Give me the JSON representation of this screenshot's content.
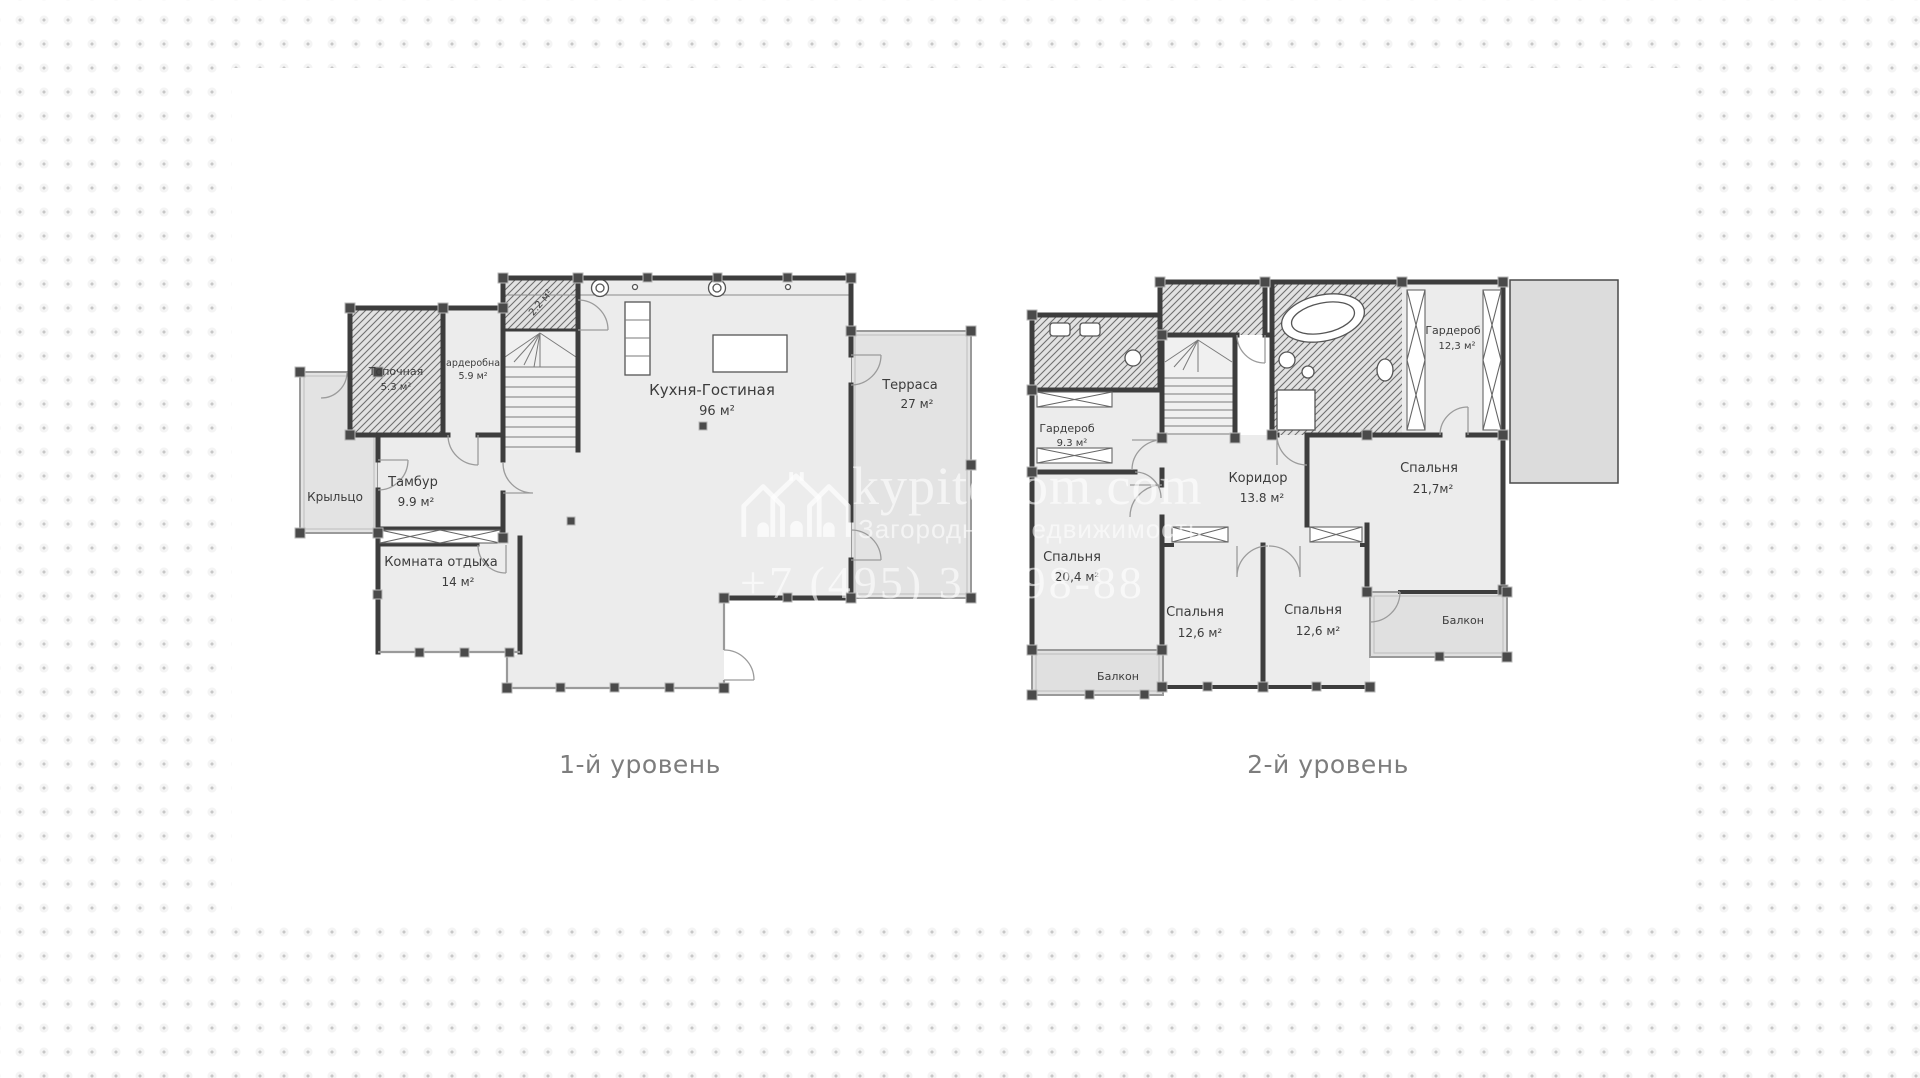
{
  "colors": {
    "wall": "#3d3d3d",
    "room_fill": "#ececec",
    "terrace_fill": "#e3e3e3",
    "background_dot": "#c7c7c7",
    "caption_text": "#7d7d7d",
    "watermark_white": "#ffffff"
  },
  "watermark": {
    "site": "kypitedom.com",
    "tagline": "Загородная недвижимость",
    "phone": "+7 (495) 3    98-88",
    "logo_icon": "houses-logo"
  },
  "plans": {
    "level1": {
      "caption": "1-й уровень",
      "rooms": {
        "boiler": {
          "name": "Топочная",
          "area": "5.3 м²"
        },
        "wardrobe": {
          "name": "Гардеробная",
          "area": "5.9 м²"
        },
        "closet": {
          "area": "2.2 м²"
        },
        "kitchen": {
          "name": "Кухня-Гостиная",
          "area": "96 м²"
        },
        "terrace": {
          "name": "Терраса",
          "area": "27 м²"
        },
        "porch": {
          "name": "Крыльцо"
        },
        "hall": {
          "name": "Тамбур",
          "area": "9.9 м²"
        },
        "lounge": {
          "name": "Комната отдыха",
          "area": "14 м²"
        }
      }
    },
    "level2": {
      "caption": "2-й уровень",
      "rooms": {
        "wardrobe1": {
          "name": "Гардероб",
          "area": "9.3 м²"
        },
        "bedroom1": {
          "name": "Спальня",
          "area": "20,4 м²"
        },
        "balcony1": {
          "name": "Балкон"
        },
        "corridor": {
          "name": "Коридор",
          "area": "13.8 м²"
        },
        "bedroom2": {
          "name": "Спальня",
          "area": "12,6 м²"
        },
        "bedroom3": {
          "name": "Спальня",
          "area": "12,6 м²"
        },
        "bedroom4": {
          "name": "Спальня",
          "area": "21,7м²"
        },
        "wardrobe2": {
          "name": "Гардероб",
          "area": "12,3 м²"
        },
        "balcony2": {
          "name": "Балкон"
        }
      }
    }
  }
}
